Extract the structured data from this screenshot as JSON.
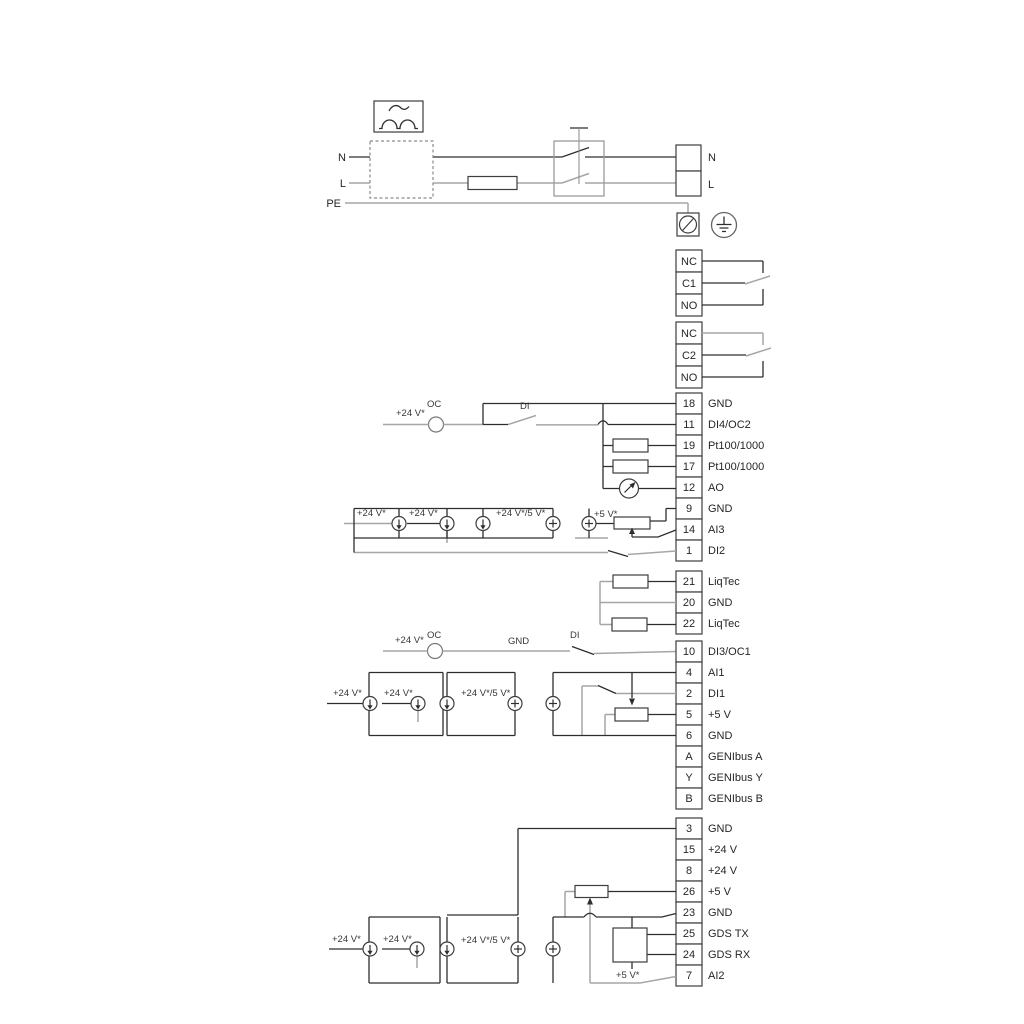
{
  "power": {
    "n_in": "N",
    "l_in": "L",
    "pe": "PE",
    "n_out": "N",
    "l_out": "L"
  },
  "relay1": {
    "cells": [
      "NC",
      "C1",
      "NO"
    ]
  },
  "relay2": {
    "cells": [
      "NC",
      "C2",
      "NO"
    ]
  },
  "strip1": {
    "terminals": [
      {
        "num": "18",
        "label": "GND"
      },
      {
        "num": "11",
        "label": "DI4/OC2"
      },
      {
        "num": "19",
        "label": "Pt100/1000"
      },
      {
        "num": "17",
        "label": "Pt100/1000"
      },
      {
        "num": "12",
        "label": "AO"
      },
      {
        "num": "9",
        "label": "GND"
      },
      {
        "num": "14",
        "label": "AI3"
      },
      {
        "num": "1",
        "label": "DI2"
      }
    ]
  },
  "strip2": {
    "terminals": [
      {
        "num": "21",
        "label": "LiqTec"
      },
      {
        "num": "20",
        "label": "GND"
      },
      {
        "num": "22",
        "label": "LiqTec"
      }
    ]
  },
  "strip3": {
    "terminals": [
      {
        "num": "10",
        "label": "DI3/OC1"
      },
      {
        "num": "4",
        "label": "AI1"
      },
      {
        "num": "2",
        "label": "DI1"
      },
      {
        "num": "5",
        "label": "+5 V"
      },
      {
        "num": "6",
        "label": "GND"
      },
      {
        "num": "A",
        "label": "GENIbus A"
      },
      {
        "num": "Y",
        "label": "GENIbus Y"
      },
      {
        "num": "B",
        "label": "GENIbus B"
      }
    ]
  },
  "strip4": {
    "terminals": [
      {
        "num": "3",
        "label": "GND"
      },
      {
        "num": "15",
        "label": "+24 V"
      },
      {
        "num": "8",
        "label": "+24 V"
      },
      {
        "num": "26",
        "label": "+5 V"
      },
      {
        "num": "23",
        "label": "GND"
      },
      {
        "num": "25",
        "label": "GDS TX"
      },
      {
        "num": "24",
        "label": "GDS RX"
      },
      {
        "num": "7",
        "label": "AI2"
      }
    ]
  },
  "annot": {
    "row18": {
      "v24": "+24 V*",
      "oc": "OC",
      "di": "DI"
    },
    "ai3": {
      "v24a": "+24 V*",
      "v24b": "+24 V*",
      "v24v5": "+24 V*/5 V*",
      "v5": "+5 V*"
    },
    "row10": {
      "v24": "+24 V*",
      "oc": "OC",
      "gnd": "GND",
      "di": "DI"
    },
    "ai1": {
      "v24a": "+24 V*",
      "v24b": "+24 V*",
      "v24v5": "+24 V*/5 V*"
    },
    "ai2": {
      "v24a": "+24 V*",
      "v24b": "+24 V*",
      "v24v5": "+24 V*/5 V*",
      "v5": "+5 V*"
    }
  },
  "colors": {
    "wire_dark": "#2e2e2e",
    "wire_gray": "#a6a6a6",
    "text": "#262626"
  }
}
